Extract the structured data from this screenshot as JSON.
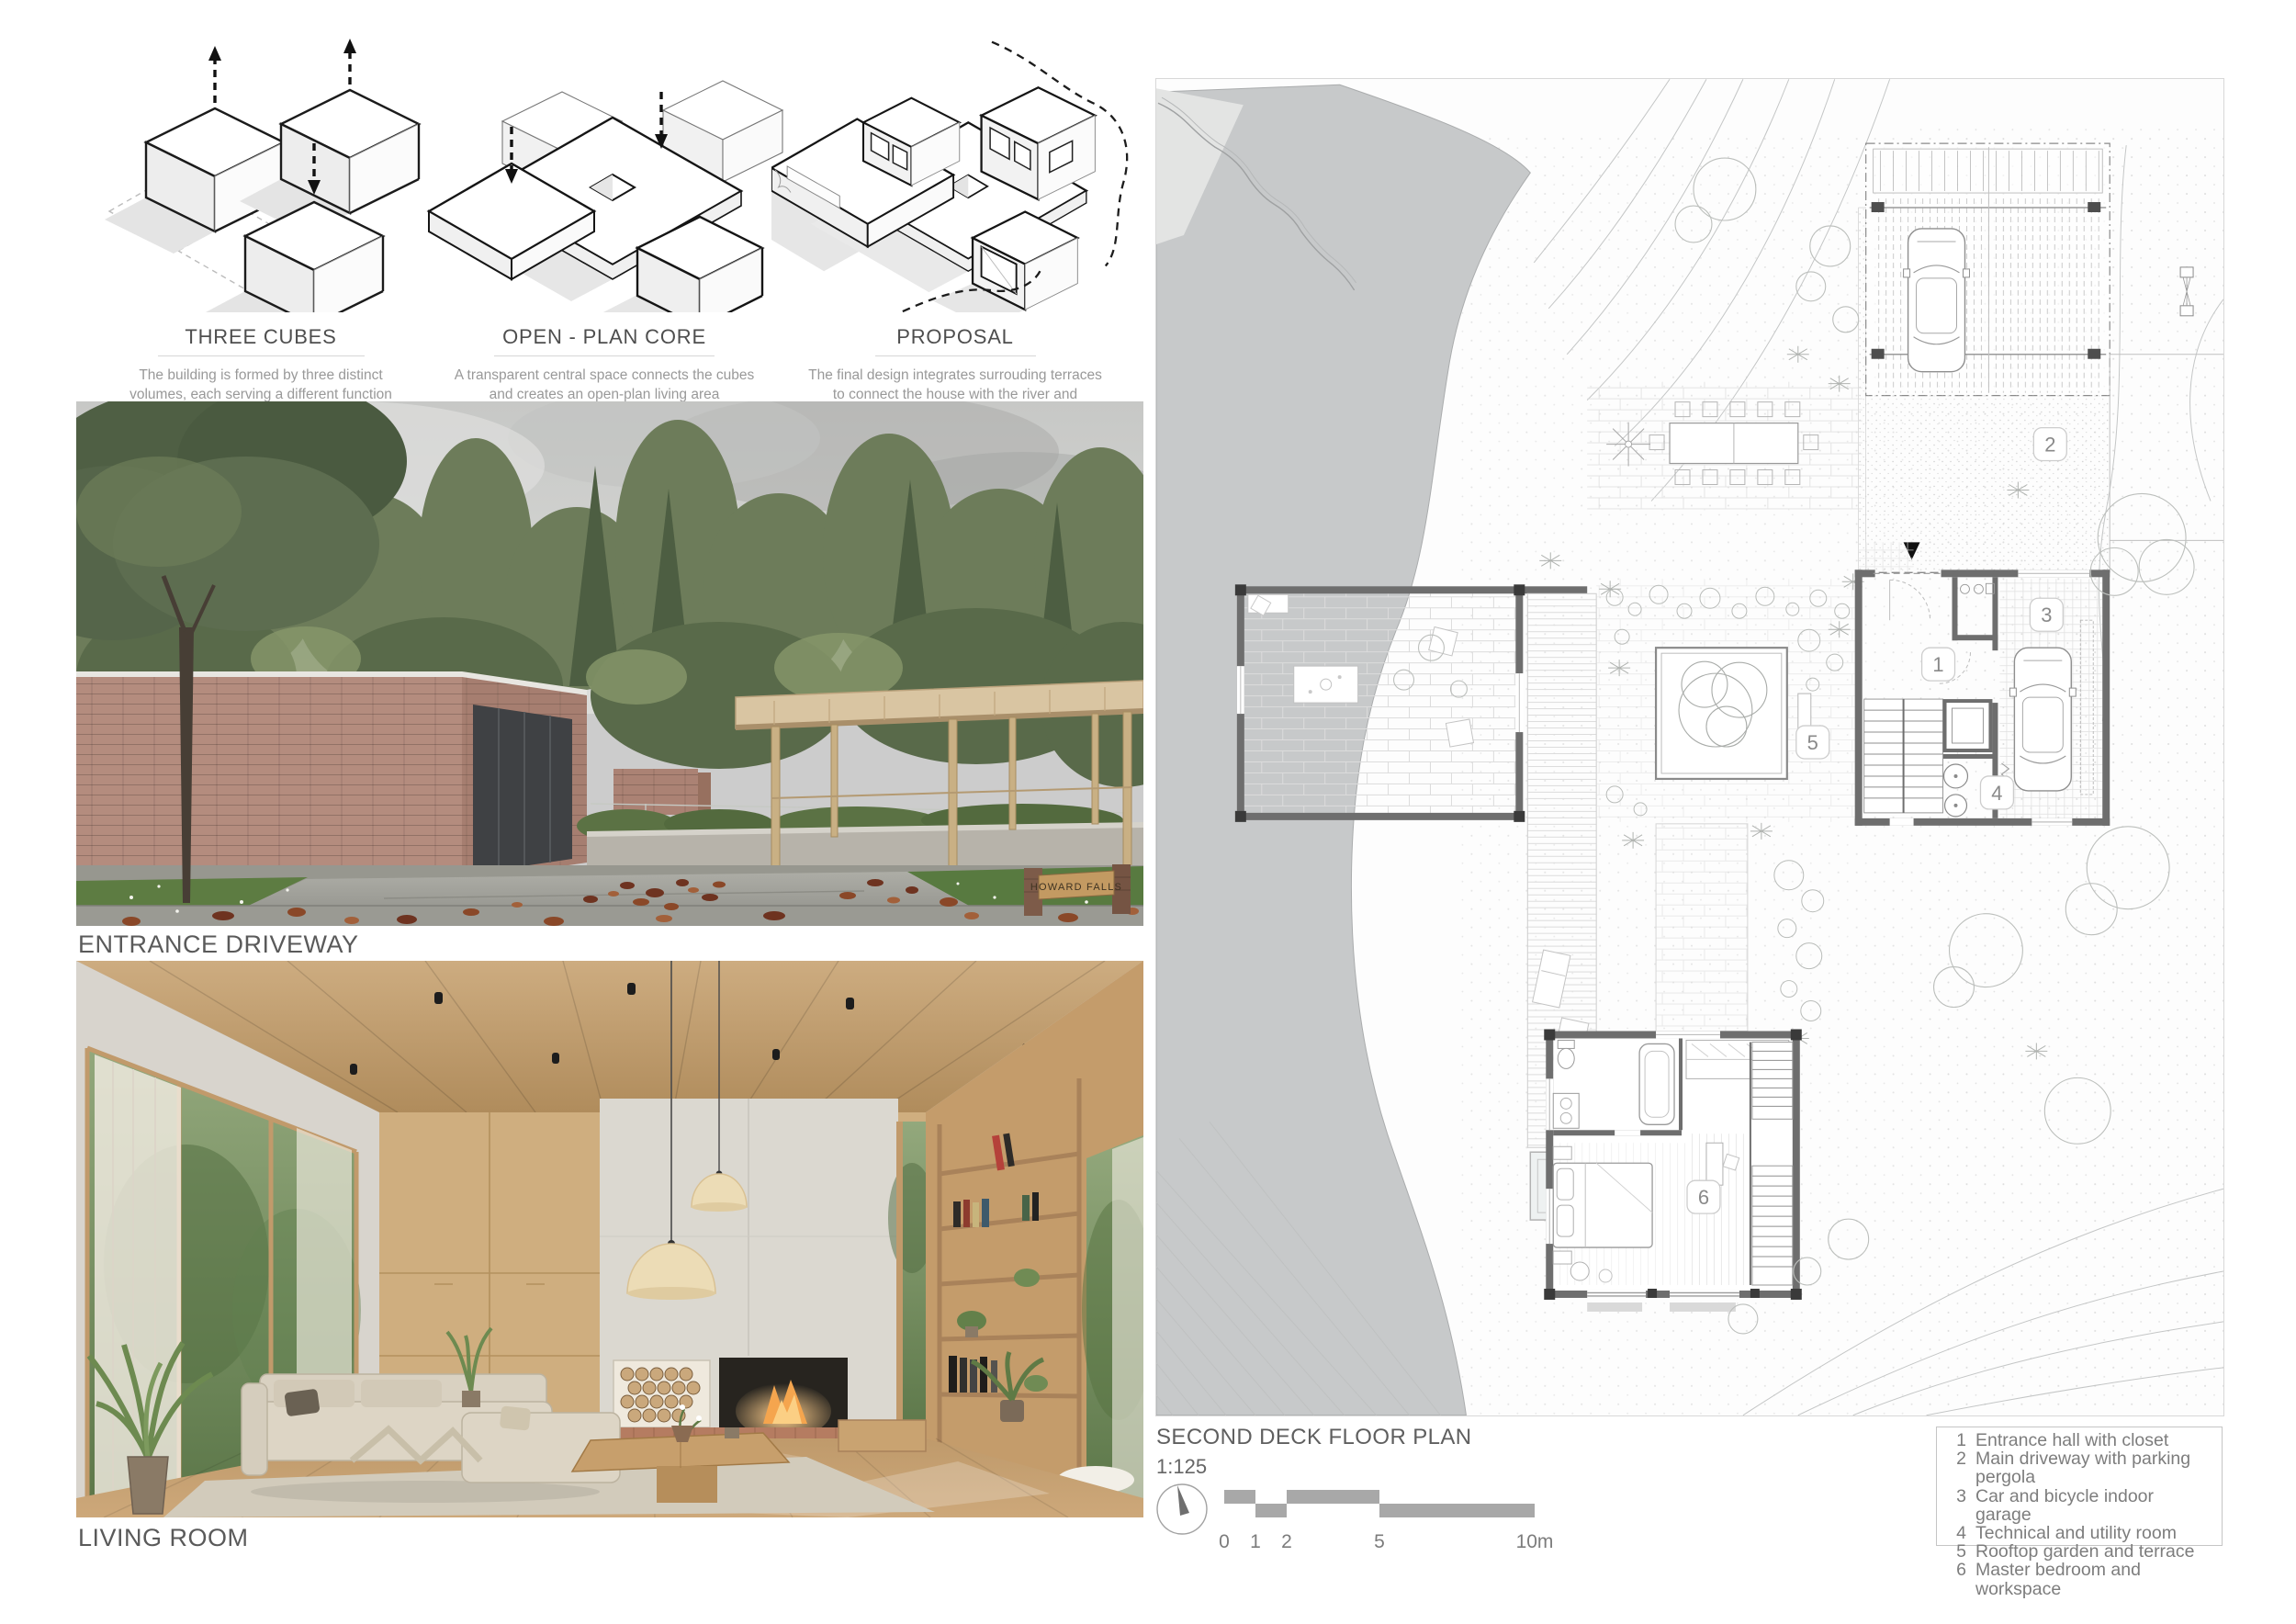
{
  "concepts": [
    {
      "title": "THREE CUBES",
      "description": "The building is formed by three distinct volumes, each serving a different function"
    },
    {
      "title": "OPEN - PLAN CORE",
      "description": "A transparent central space connects the cubes and creates an open-plan living area"
    },
    {
      "title": "PROPOSAL",
      "description": "The final design integrates surrouding terraces to connect the house with the river and landscape"
    }
  ],
  "renders": [
    {
      "label": "ENTRANCE DRIVEWAY",
      "sign_text": "HOWARD FALLS"
    },
    {
      "label": "LIVING ROOM"
    }
  ],
  "floor_plan": {
    "title": "SECOND DECK FLOOR PLAN",
    "scale": "1:125",
    "scale_bar_labels": [
      "0",
      "1",
      "2",
      "5",
      "10m"
    ],
    "plan_numbers": [
      "1",
      "2",
      "3",
      "4",
      "5",
      "6"
    ],
    "legend": [
      {
        "num": "1",
        "label": "Entrance hall with closet"
      },
      {
        "num": "2",
        "label": "Main driveway with parking pergola"
      },
      {
        "num": "3",
        "label": "Car and bicycle indoor garage"
      },
      {
        "num": "4",
        "label": "Technical and utility room"
      },
      {
        "num": "5",
        "label": "Rooftop garden and terrace"
      },
      {
        "num": "6",
        "label": "Master bedroom and workspace"
      }
    ]
  },
  "colors": {
    "water": "#c7c9ca",
    "plan_wall": "#6e6e6e",
    "badge_text": "#8a8a8a",
    "brick_render": "#b48c7e",
    "wood": "#c9a878",
    "grass": "#5d7c42",
    "fire_glow": "#f2a95c",
    "scalebar": "#a8a8a8"
  }
}
